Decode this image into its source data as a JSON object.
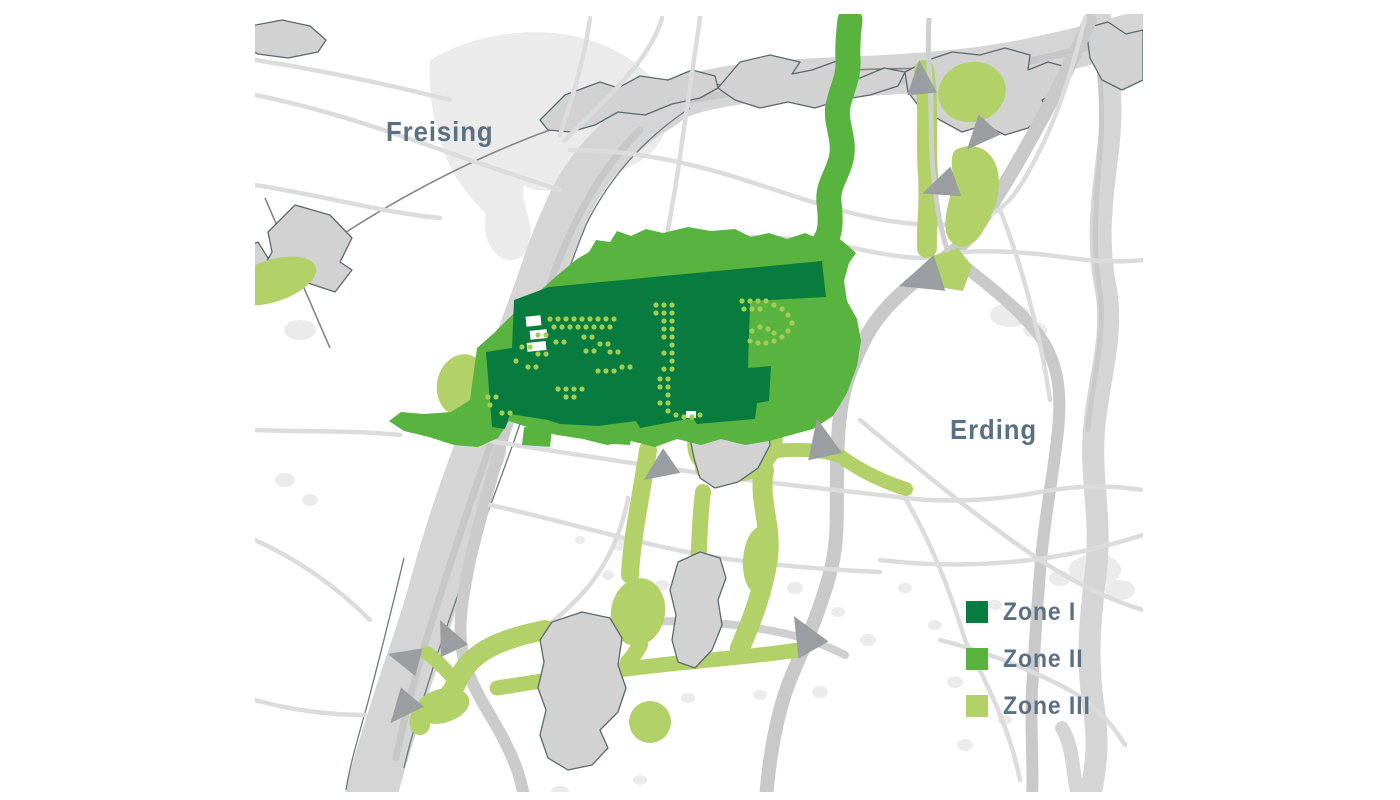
{
  "map": {
    "city_labels": {
      "northwest": "Freising",
      "east": "Erding"
    },
    "legend": {
      "items": [
        {
          "label": "Zone I",
          "color": "#077c3e"
        },
        {
          "label": "Zone II",
          "color": "#58b33f"
        },
        {
          "label": "Zone III",
          "color": "#b2d168"
        }
      ]
    },
    "colors": {
      "zone1": "#077c3e",
      "zone2": "#58b33f",
      "zone3": "#b2d168",
      "facility_dots": "#a3cc52",
      "arrow": "#9b9ea0",
      "label_text": "#5b7183",
      "background": "#ffffff"
    }
  }
}
